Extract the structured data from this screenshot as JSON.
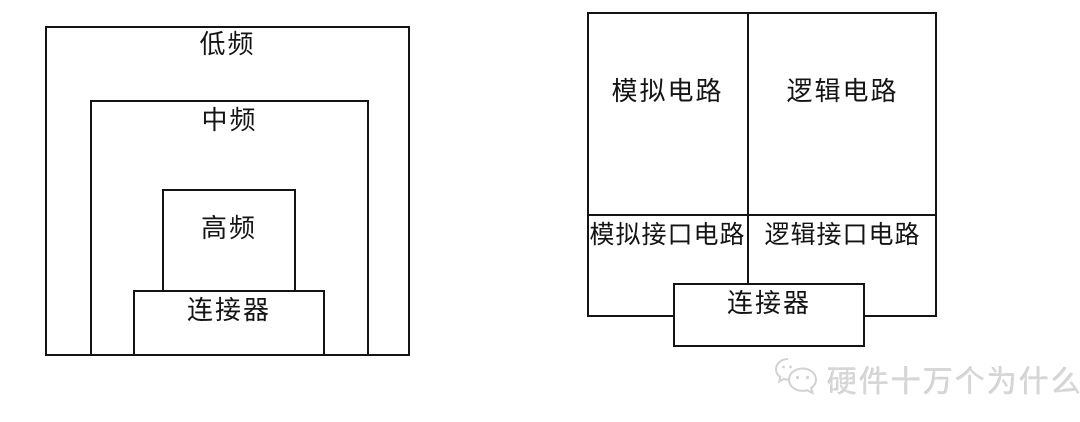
{
  "colors": {
    "line": "#141414",
    "background": "#ffffff",
    "watermark": "#d7d7d7"
  },
  "left_diagram": {
    "low_freq_label": "低频",
    "mid_freq_label": "中频",
    "high_freq_label": "高频",
    "connector_label": "连接器"
  },
  "right_diagram": {
    "analog_label": "模拟电路",
    "logic_label": "逻辑电路",
    "analog_interface_label": "模拟接口电路",
    "logic_interface_label": "逻辑接口电路",
    "connector_label": "连接器"
  },
  "watermark": {
    "text": "硬件十万个为什么",
    "icon": "chat-bubbles-icon"
  }
}
